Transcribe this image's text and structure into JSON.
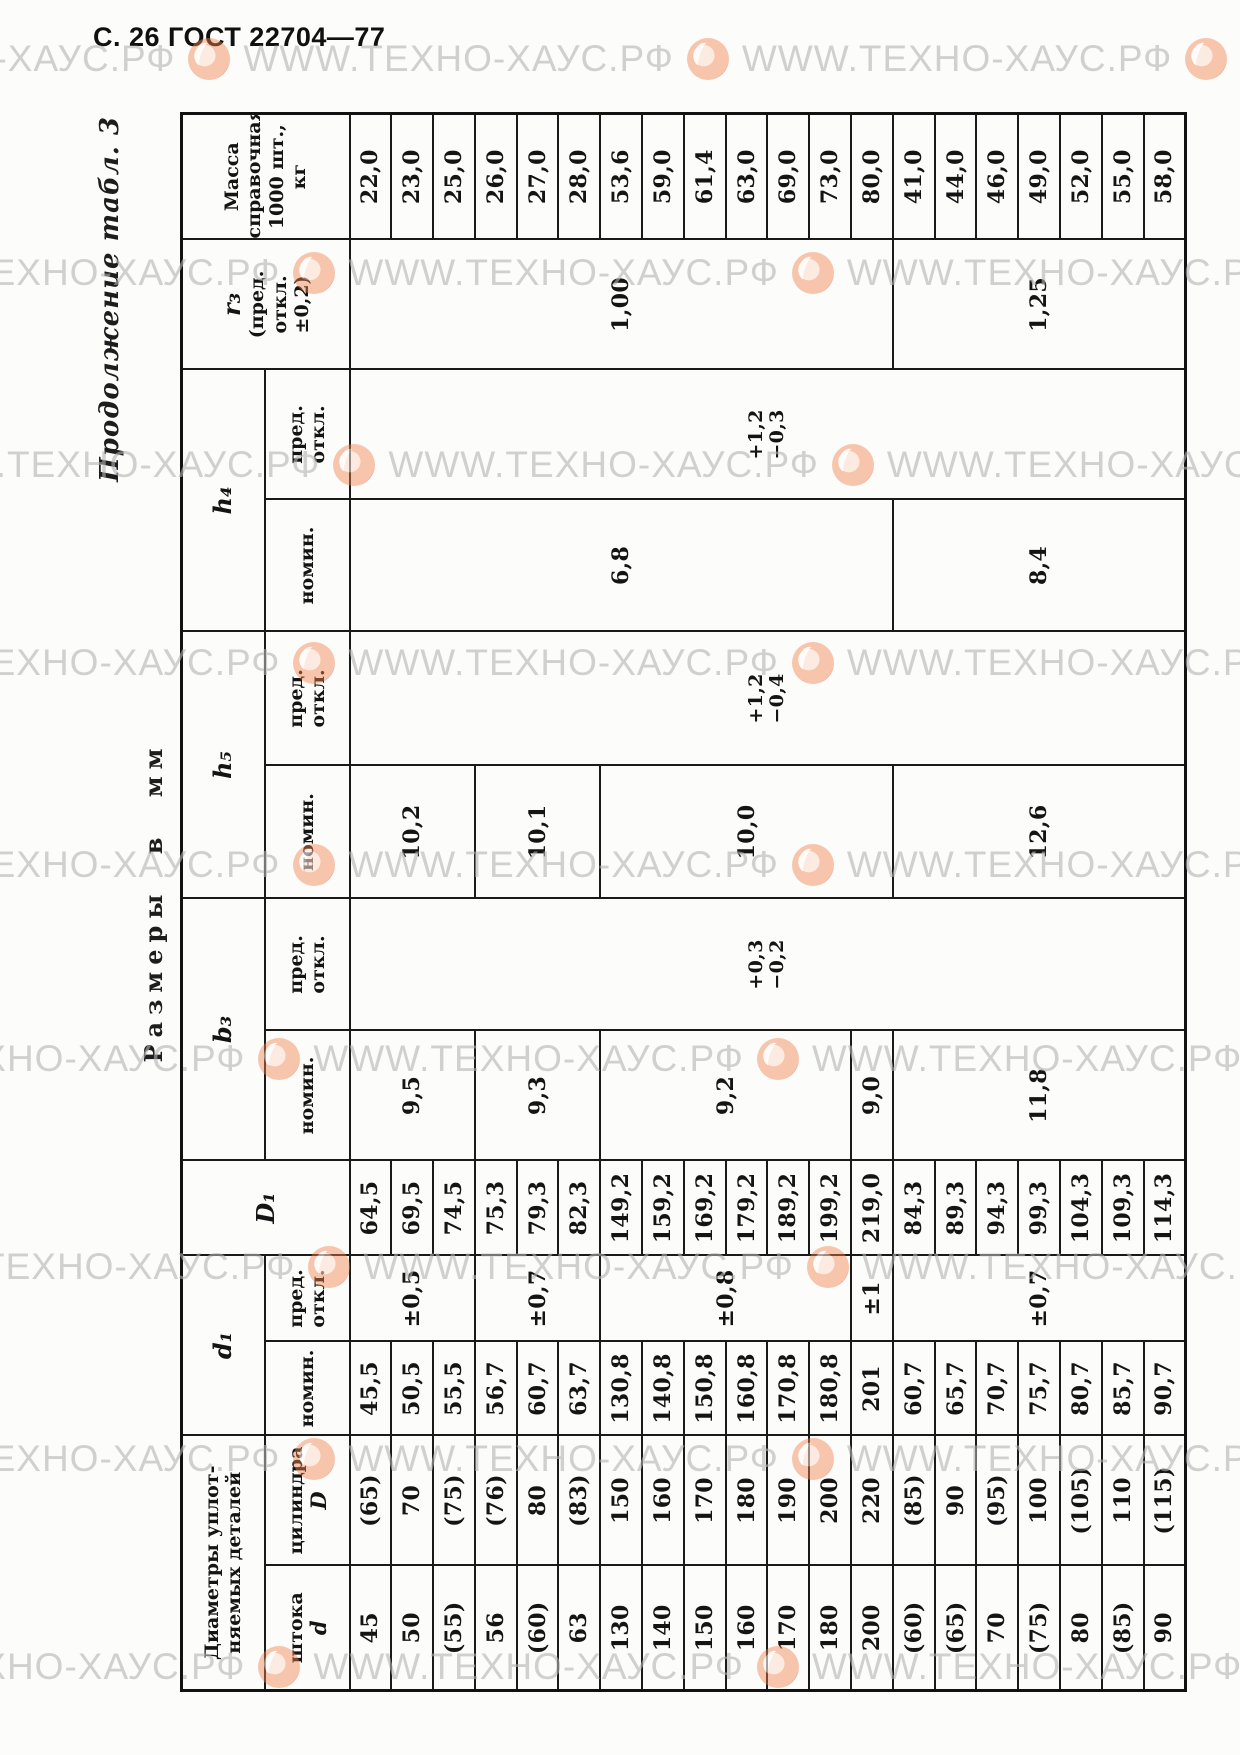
{
  "page": {
    "header": "С. 26 ГОСТ 22704—77",
    "continuation": "Продолжение табл. 3",
    "units_note": "Размеры в мм"
  },
  "watermark": {
    "text": "WWW.ТЕХНО-ХАУС.РФ",
    "color": "#b3b3b3",
    "logo_color": "#de5528",
    "row_count": 9,
    "repeats_per_row": 4
  },
  "table": {
    "groups": [
      {
        "name": "diameters",
        "label_lines": [
          "Диаметры уплот-",
          "няемых деталей"
        ],
        "children": [
          {
            "key": "d",
            "label_lines": [
              "штока",
              "d"
            ]
          },
          {
            "key": "D",
            "label_lines": [
              "цилиндра",
              "D"
            ]
          }
        ]
      },
      {
        "name": "d1",
        "label_lines": [
          "d₁"
        ],
        "italic": true,
        "children": [
          {
            "key": "d1",
            "label_lines": [
              "номин."
            ]
          },
          {
            "key": "d1_tol",
            "label_lines": [
              "пред.",
              "откл."
            ]
          }
        ]
      },
      {
        "name": "D1",
        "label_lines": [
          "D₁"
        ],
        "italic": true,
        "key": "D1"
      },
      {
        "name": "b3",
        "label_lines": [
          "b₃"
        ],
        "italic": true,
        "children": [
          {
            "key": "b3_nom",
            "label_lines": [
              "номин."
            ]
          },
          {
            "key": "b3_tol",
            "label_lines": [
              "пред.",
              "откл."
            ]
          }
        ]
      },
      {
        "name": "h5",
        "label_lines": [
          "h₅"
        ],
        "italic": true,
        "children": [
          {
            "key": "h5_nom",
            "label_lines": [
              "номин."
            ]
          },
          {
            "key": "h5_tol",
            "label_lines": [
              "пред.",
              "откл."
            ]
          }
        ]
      },
      {
        "name": "h4",
        "label_lines": [
          "h₄"
        ],
        "italic": true,
        "children": [
          {
            "key": "h4_nom",
            "label_lines": [
              "номин."
            ]
          },
          {
            "key": "h4_tol",
            "label_lines": [
              "пред.",
              "откл."
            ]
          }
        ]
      },
      {
        "name": "r3",
        "label_lines": [
          "r₃",
          "(пред.",
          "откл.",
          "±0,2)"
        ],
        "italic_first": true,
        "key": "r3"
      },
      {
        "name": "mass",
        "label_lines": [
          "Масса",
          "справочная",
          "1000 шт.,",
          "кг"
        ],
        "key": "mass"
      }
    ],
    "column_order": [
      "d",
      "D",
      "d1",
      "d1_tol",
      "D1",
      "b3_nom",
      "b3_tol",
      "h5_nom",
      "h5_tol",
      "h4_nom",
      "h4_tol",
      "r3",
      "mass"
    ],
    "per_row_keys": [
      "d",
      "D",
      "d1",
      "D1",
      "mass"
    ],
    "rows": [
      {
        "d": "45",
        "D": "(65)",
        "d1": "45,5",
        "D1": "64,5",
        "mass": "22,0"
      },
      {
        "d": "50",
        "D": "70",
        "d1": "50,5",
        "D1": "69,5",
        "mass": "23,0"
      },
      {
        "d": "(55)",
        "D": "(75)",
        "d1": "55,5",
        "D1": "74,5",
        "mass": "25,0"
      },
      {
        "d": "56",
        "D": "(76)",
        "d1": "56,7",
        "D1": "75,3",
        "mass": "26,0"
      },
      {
        "d": "(60)",
        "D": "80",
        "d1": "60,7",
        "D1": "79,3",
        "mass": "27,0"
      },
      {
        "d": "63",
        "D": "(83)",
        "d1": "63,7",
        "D1": "82,3",
        "mass": "28,0"
      },
      {
        "d": "130",
        "D": "150",
        "d1": "130,8",
        "D1": "149,2",
        "mass": "53,6"
      },
      {
        "d": "140",
        "D": "160",
        "d1": "140,8",
        "D1": "159,2",
        "mass": "59,0"
      },
      {
        "d": "150",
        "D": "170",
        "d1": "150,8",
        "D1": "169,2",
        "mass": "61,4"
      },
      {
        "d": "160",
        "D": "180",
        "d1": "160,8",
        "D1": "179,2",
        "mass": "63,0"
      },
      {
        "d": "170",
        "D": "190",
        "d1": "170,8",
        "D1": "189,2",
        "mass": "69,0"
      },
      {
        "d": "180",
        "D": "200",
        "d1": "180,8",
        "D1": "199,2",
        "mass": "73,0"
      },
      {
        "d": "200",
        "D": "220",
        "d1": "201",
        "D1": "219,0",
        "mass": "80,0"
      },
      {
        "d": "(60)",
        "D": "(85)",
        "d1": "60,7",
        "D1": "84,3",
        "mass": "41,0"
      },
      {
        "d": "(65)",
        "D": "90",
        "d1": "65,7",
        "D1": "89,3",
        "mass": "44,0"
      },
      {
        "d": "70",
        "D": "(95)",
        "d1": "70,7",
        "D1": "94,3",
        "mass": "46,0"
      },
      {
        "d": "(75)",
        "D": "100",
        "d1": "75,7",
        "D1": "99,3",
        "mass": "49,0"
      },
      {
        "d": "80",
        "D": "(105)",
        "d1": "80,7",
        "D1": "104,3",
        "mass": "52,0"
      },
      {
        "d": "(85)",
        "D": "110",
        "d1": "85,7",
        "D1": "109,3",
        "mass": "55,0"
      },
      {
        "d": "90",
        "D": "(115)",
        "d1": "90,7",
        "D1": "114,3",
        "mass": "58,0"
      }
    ],
    "merged": {
      "d1_tol": [
        {
          "value": "±0,5",
          "from": 1,
          "to": 3
        },
        {
          "value": "±0,7",
          "from": 4,
          "to": 6
        },
        {
          "value": "±0,8",
          "from": 7,
          "to": 12
        },
        {
          "value": "±1",
          "from": 13,
          "to": 13
        },
        {
          "value": "±0,7",
          "from": 14,
          "to": 20
        }
      ],
      "b3_nom": [
        {
          "value": "9,5",
          "from": 1,
          "to": 3
        },
        {
          "value": "9,3",
          "from": 4,
          "to": 6
        },
        {
          "value": "9,2",
          "from": 7,
          "to": 12
        },
        {
          "value": "9,0",
          "from": 13,
          "to": 13
        },
        {
          "value": "11,8",
          "from": 14,
          "to": 20
        }
      ],
      "b3_tol": [
        {
          "lines": [
            "+0,3",
            "−0,2"
          ],
          "from": 1,
          "to": 20
        }
      ],
      "h5_nom": [
        {
          "value": "10,2",
          "from": 1,
          "to": 3
        },
        {
          "value": "10,1",
          "from": 4,
          "to": 6
        },
        {
          "value": "10,0",
          "from": 7,
          "to": 13
        },
        {
          "value": "12,6",
          "from": 14,
          "to": 20
        }
      ],
      "h5_tol": [
        {
          "lines": [
            "+1,2",
            "−0,4"
          ],
          "from": 1,
          "to": 20
        }
      ],
      "h4_nom": [
        {
          "value": "6,8",
          "from": 1,
          "to": 13
        },
        {
          "value": "8,4",
          "from": 14,
          "to": 20
        }
      ],
      "h4_tol": [
        {
          "lines": [
            "+1,2",
            "−0,3"
          ],
          "from": 1,
          "to": 20
        }
      ],
      "r3": [
        {
          "value": "1,00",
          "from": 1,
          "to": 13
        },
        {
          "value": "1,25",
          "from": 14,
          "to": 20
        }
      ]
    }
  }
}
